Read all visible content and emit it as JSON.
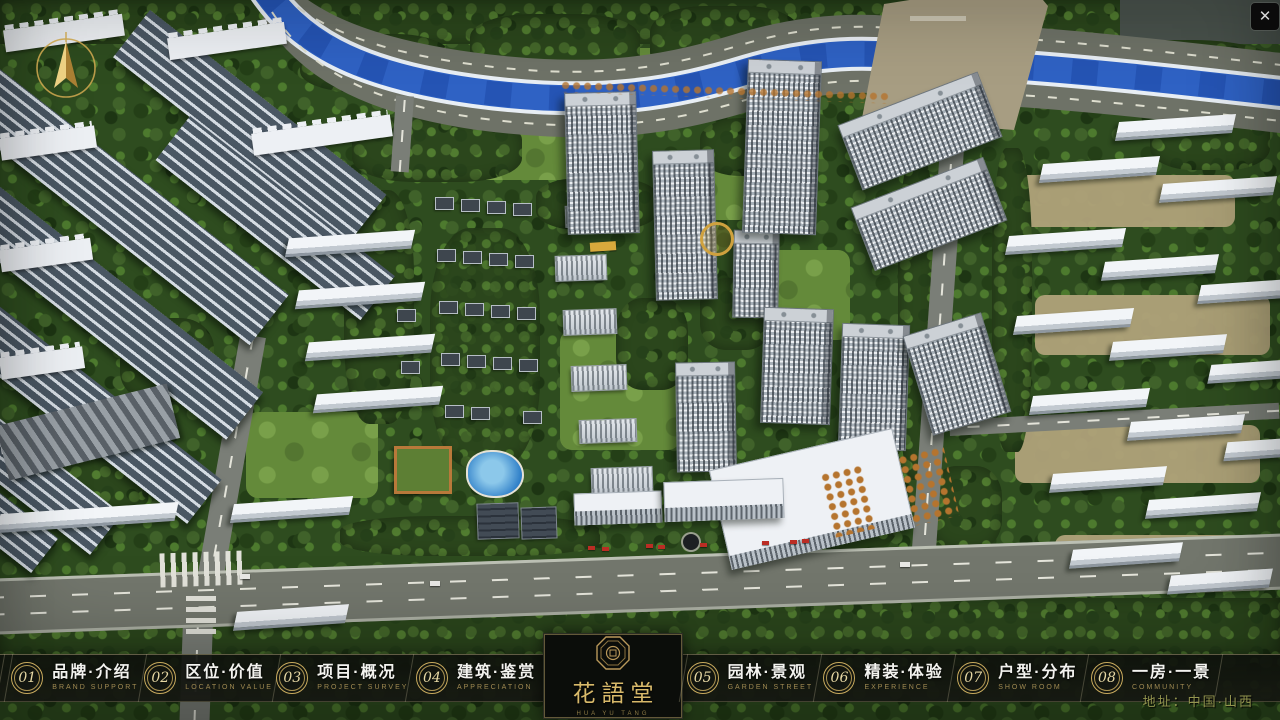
{
  "window": {
    "close_glyph": "✕"
  },
  "compass": {
    "label": "north-compass"
  },
  "nav": {
    "items": [
      {
        "num": "01",
        "zh": "品牌·介绍",
        "en": "BRAND SUPPORT"
      },
      {
        "num": "02",
        "zh": "区位·价值",
        "en": "LOCATION VALUE"
      },
      {
        "num": "03",
        "zh": "项目·概况",
        "en": "PROJECT SURVEY"
      },
      {
        "num": "04",
        "zh": "建筑·鉴赏",
        "en": "APPRECIATION"
      },
      {
        "num": "05",
        "zh": "园林·景观",
        "en": "GARDEN STREET"
      },
      {
        "num": "06",
        "zh": "精装·体验",
        "en": "EXPERIENCE"
      },
      {
        "num": "07",
        "zh": "户型·分布",
        "en": "SHOW ROOM"
      },
      {
        "num": "08",
        "zh": "一房·一景",
        "en": "COMMUNITY"
      }
    ]
  },
  "logo": {
    "title": "花語堂",
    "caption": "HUA YU TANG"
  },
  "footer": {
    "address": "地址：中国·山西"
  },
  "colors": {
    "gold": "#c9ab5e",
    "nav_bg": "#12140f",
    "river": "#2f62c4",
    "address_text": "#93954f"
  }
}
